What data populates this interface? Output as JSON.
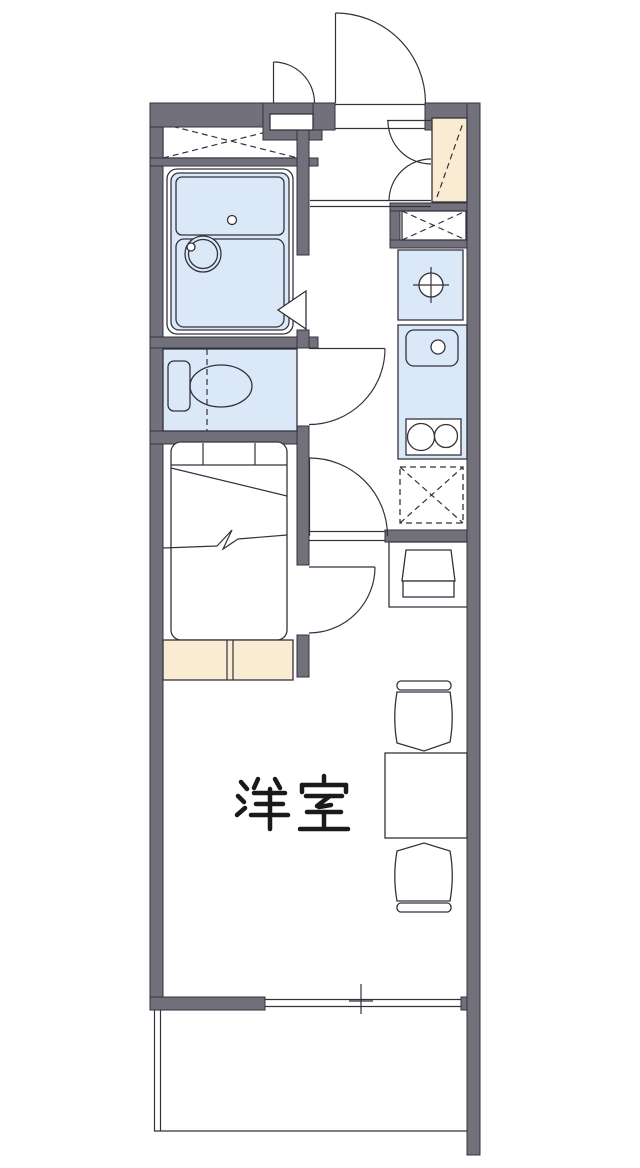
{
  "floorplan": {
    "room_label": "洋室",
    "colors": {
      "wall": "#72707b",
      "line": "#33323d",
      "water_fixture": "#dbe8f7",
      "storage_accent": "#faecd2",
      "background": "#ffffff"
    },
    "fixtures": [
      "entrance-door",
      "meter-box-door",
      "shoe-cabinet",
      "closet-storage",
      "unit-bath",
      "bathtub",
      "washbasin",
      "toilet",
      "bed",
      "storage-step",
      "washing-machine-space",
      "kitchen-sink",
      "stove-burners",
      "refrigerator-space",
      "desk",
      "stool",
      "table",
      "chair",
      "window",
      "balcony"
    ]
  }
}
